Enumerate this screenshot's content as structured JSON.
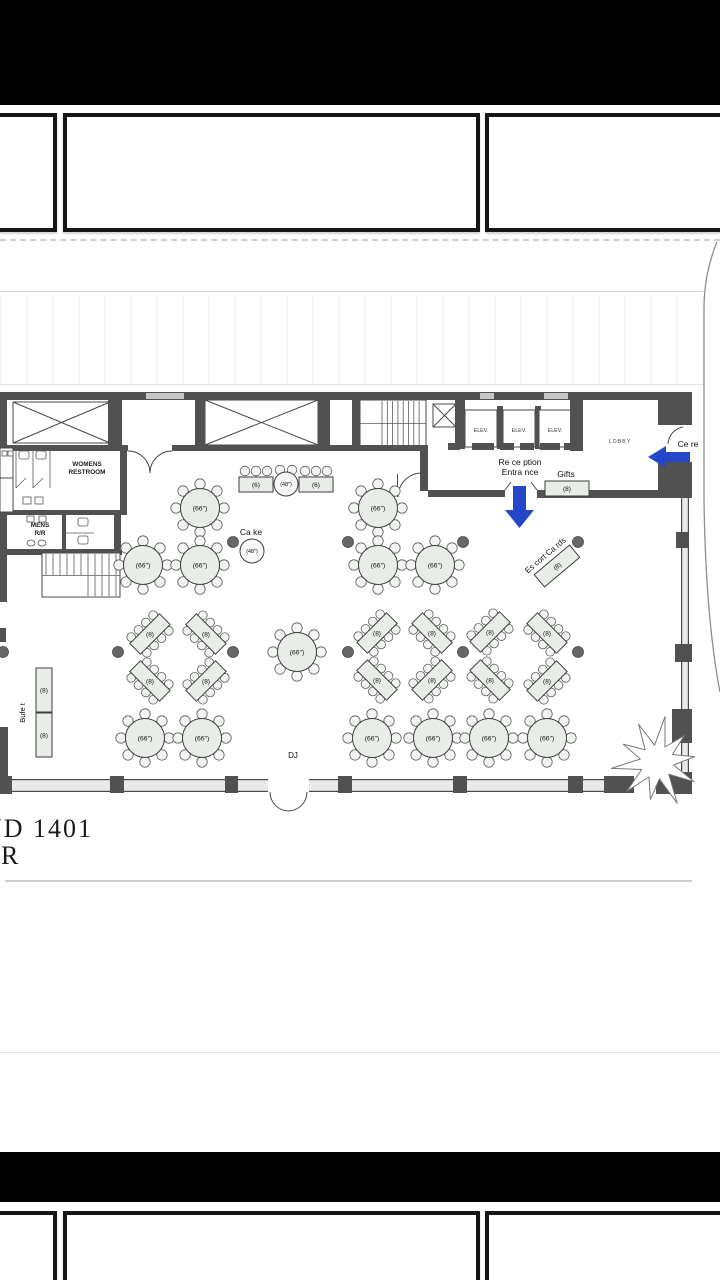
{
  "viewer": {
    "top_thumbnails": 3,
    "bottom_thumbnails": 3
  },
  "plan": {
    "accent_blue": "#2446c8",
    "room_labels": [
      {
        "name": "womens-restroom",
        "lines": [
          "WOMENS",
          "RESTROOM"
        ],
        "x": 87,
        "y": 466,
        "size": 6.4,
        "bold": true
      },
      {
        "name": "mens-restroom",
        "lines": [
          "MENS",
          "R/R"
        ],
        "x": 40,
        "y": 527,
        "size": 6.4,
        "bold": true
      },
      {
        "name": "elevator-1",
        "lines": [
          "ELEV."
        ],
        "x": 481,
        "y": 432,
        "size": 5.4
      },
      {
        "name": "elevator-2",
        "lines": [
          "ELEV."
        ],
        "x": 519,
        "y": 432,
        "size": 5.4
      },
      {
        "name": "elevator-3",
        "lines": [
          "ELEV."
        ],
        "x": 555,
        "y": 432,
        "size": 5.4
      },
      {
        "name": "lobby",
        "lines": [
          "LOBBY"
        ],
        "x": 620,
        "y": 443,
        "size": 5.2,
        "spacing": 1.1
      }
    ],
    "annotations": [
      {
        "name": "reception-entrance",
        "lines": [
          "Re ce ption",
          "Entra nce"
        ],
        "x": 520,
        "y": 465,
        "size": 8.5
      },
      {
        "name": "gifts",
        "lines": [
          "Gifts"
        ],
        "x": 566,
        "y": 477,
        "size": 8.5
      },
      {
        "name": "cake",
        "lines": [
          "Ca ke"
        ],
        "x": 251,
        "y": 535,
        "size": 8.5
      },
      {
        "name": "dj",
        "lines": [
          "DJ"
        ],
        "x": 293,
        "y": 758,
        "size": 8
      },
      {
        "name": "ceremony",
        "lines": [
          "Ce re"
        ],
        "x": 688,
        "y": 447,
        "size": 8.5,
        "anchor": "start"
      }
    ],
    "buffet_label": {
      "text": "Bufe t",
      "x": 25,
      "y": 713,
      "size": 7.5
    },
    "escort": {
      "text": "Es cort Ca rds",
      "label": "(8)",
      "x": 557,
      "y": 566,
      "rot": -40,
      "w": 46,
      "h": 16,
      "text_size": 8,
      "label_size": 6.5
    },
    "sheet_title": {
      "line1": "ND 1401",
      "line2": "R"
    },
    "tables": {
      "round_66": {
        "label": "(66\")",
        "radius": 19.5,
        "positions": [
          [
            200,
            508
          ],
          [
            378,
            508
          ],
          [
            143,
            565
          ],
          [
            200,
            565
          ],
          [
            378,
            565
          ],
          [
            435,
            565
          ],
          [
            297,
            652
          ],
          [
            145,
            738
          ],
          [
            202,
            738
          ],
          [
            372,
            738
          ],
          [
            433,
            738
          ],
          [
            489,
            738
          ],
          [
            547,
            738
          ]
        ]
      },
      "diag_8": {
        "label": "(8)",
        "positions": [
          [
            150,
            634,
            -1
          ],
          [
            206,
            634,
            1
          ],
          [
            150,
            681,
            1
          ],
          [
            206,
            681,
            -1
          ],
          [
            377,
            633,
            -1
          ],
          [
            432,
            633,
            1
          ],
          [
            490,
            632,
            -1
          ],
          [
            547,
            633,
            1
          ],
          [
            377,
            680,
            1
          ],
          [
            432,
            680,
            -1
          ],
          [
            490,
            680,
            1
          ],
          [
            547,
            681,
            -1
          ]
        ]
      },
      "head": {
        "rect_label": "(6)",
        "round_label": "(48\")",
        "rect_x": [
          256,
          316
        ],
        "rect_y": 477,
        "round": [
          286,
          484
        ]
      },
      "cake_table": {
        "label": "(48\")",
        "x": 252,
        "y": 551,
        "r": 12
      },
      "gifts_table": {
        "label": "(8)",
        "x": 545,
        "y": 481,
        "w": 44,
        "h": 15
      },
      "buffet_tables": {
        "label": "(8)",
        "rects": [
          [
            36,
            668,
            16,
            44
          ],
          [
            36,
            713,
            16,
            44
          ]
        ]
      }
    },
    "columns": [
      [
        233,
        542
      ],
      [
        348,
        542
      ],
      [
        463,
        542
      ],
      [
        578,
        542
      ],
      [
        3,
        652
      ],
      [
        118,
        652
      ],
      [
        233,
        652
      ],
      [
        348,
        652
      ],
      [
        463,
        652
      ],
      [
        578,
        652
      ]
    ],
    "arrows": {
      "down": {
        "x": 519.5,
        "y1": 486,
        "y2": 528
      },
      "left": {
        "x1": 648,
        "x2": 690,
        "y": 457
      }
    }
  }
}
